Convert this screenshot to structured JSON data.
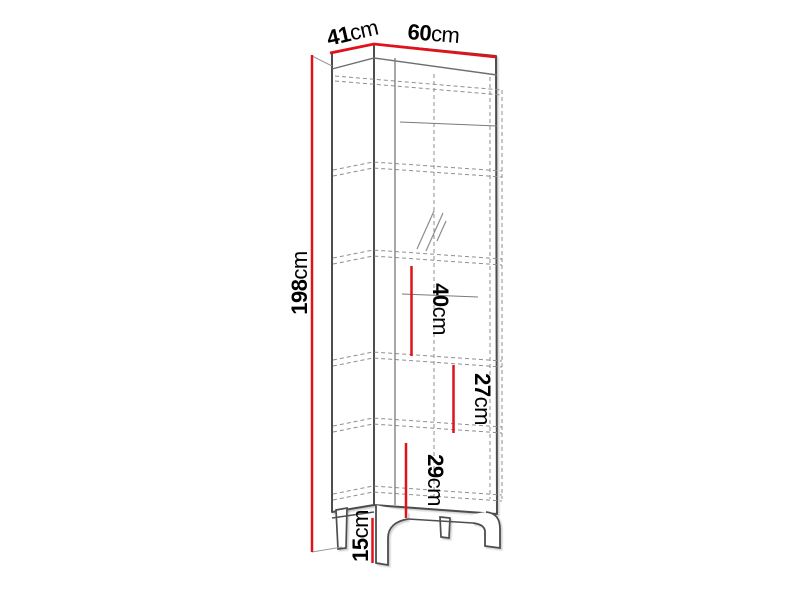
{
  "diagram": {
    "type": "furniture-dimension-drawing",
    "subject": "tall display cabinet with glass door, five shelf compartments and four legs",
    "unit": "cm",
    "dimensions_cm": {
      "depth": 41,
      "width": 60,
      "height": 198,
      "compartment_gap_upper": 40,
      "compartment_gap_middle": 27,
      "compartment_gap_lower": 29,
      "leg_height": 15
    },
    "labels": {
      "depth": {
        "value": "41",
        "unit": "cm"
      },
      "width": {
        "value": "60",
        "unit": "cm"
      },
      "height": {
        "value": "198",
        "unit": "cm"
      },
      "gap_upper": {
        "value": "40",
        "unit": "cm"
      },
      "gap_middle": {
        "value": "27",
        "unit": "cm"
      },
      "gap_lower": {
        "value": "29",
        "unit": "cm"
      },
      "leg": {
        "value": "15",
        "unit": "cm"
      }
    },
    "colors": {
      "dimension_red": "#e2121b",
      "outline_dark": "#4e4e4e",
      "outline_mid": "#757575",
      "hidden_line": "#8f8f8f",
      "background": "#ffffff"
    }
  }
}
